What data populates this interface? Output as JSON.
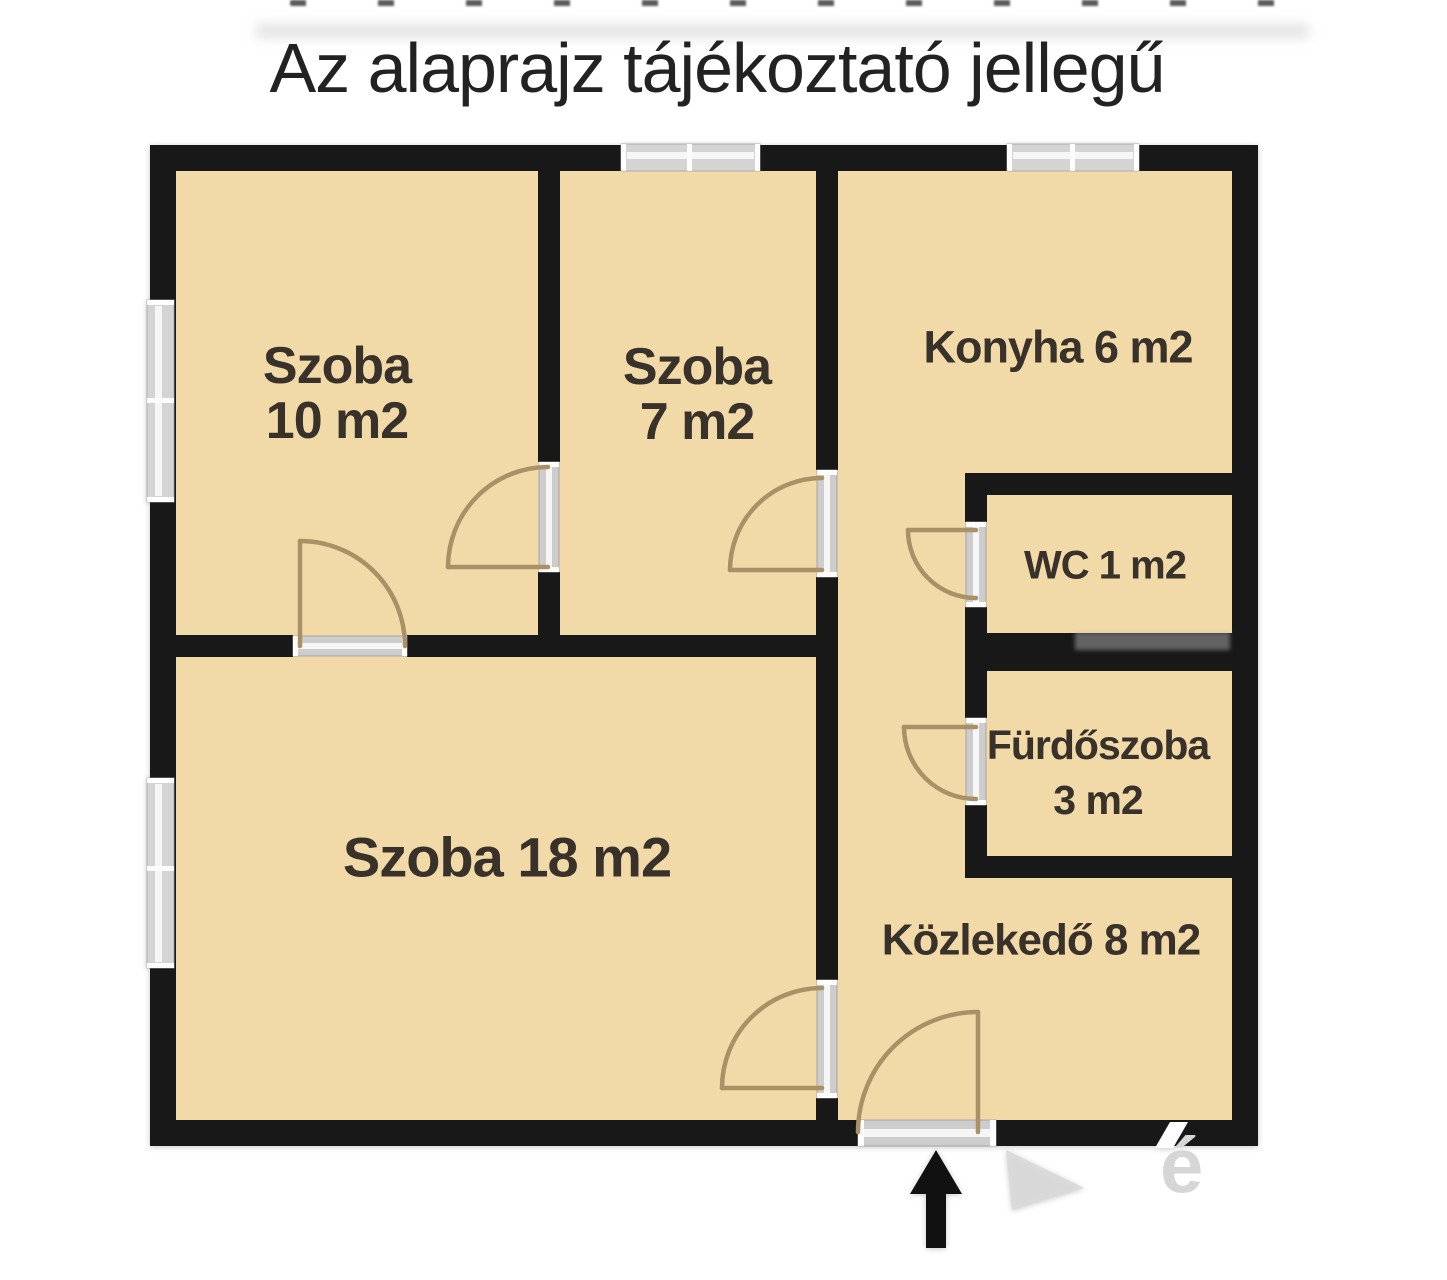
{
  "title": "Az alaprajz tájékoztató jellegű",
  "rooms": {
    "szoba10": {
      "name": "Szoba",
      "area": "10 m2"
    },
    "szoba7": {
      "name": "Szoba",
      "area": "7 m2"
    },
    "konyha": {
      "label": "Konyha 6 m2"
    },
    "wc": {
      "label": "WC 1 m2"
    },
    "furdoszoba": {
      "name": "Fürdőszoba",
      "area": "3 m2"
    },
    "szoba18": {
      "label": "Szoba 18 m2"
    },
    "kozlekedo": {
      "label": "Közlekedő 8 m2"
    }
  },
  "watermark": {
    "fragment": "é"
  },
  "colors": {
    "floor": "#f2d9a8",
    "wall": "#181818",
    "door_arc": "#aa9066",
    "window_frame": "#d4d4d4",
    "label_text": "#39322a"
  }
}
